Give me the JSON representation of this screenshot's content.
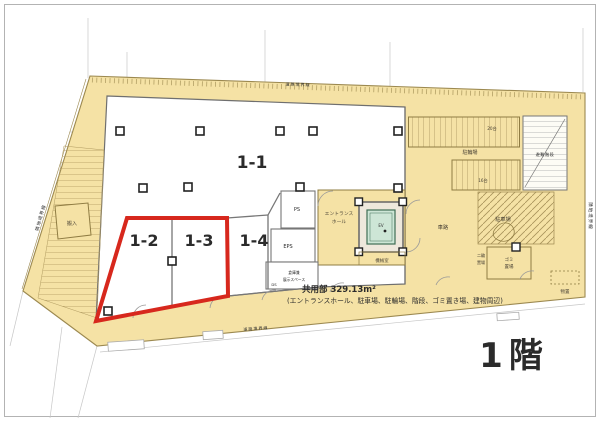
{
  "floor": {
    "label": "1階"
  },
  "common_area": {
    "line1": "共用部  329.13m²",
    "line2": "(エントランスホール、駐車場、駐輪場、階段、ゴミ置き場、建物周辺)"
  },
  "units": {
    "u11": "1-1",
    "u12": "1-2",
    "u13": "1-3",
    "u14": "1-4"
  },
  "labels": {
    "bike_parking": "駐輪場",
    "rack_20": "20台",
    "rack_16": "16台",
    "car_path": "車路",
    "parking": "駐車場",
    "garbage_1": "ゴミ",
    "garbage_2": "置場",
    "entrance_1": "エントランス",
    "entrance_2": "ホール",
    "ev": "EV",
    "machine_room": "機械室",
    "ps": "PS",
    "eps": "EPS",
    "ds": "DS",
    "storage_1": "倉庫兼",
    "storage_2": "展示スペース",
    "loading": "搬入",
    "two_wheel_1": "二輪",
    "two_wheel_2": "置場",
    "shed": "物置",
    "stairs": "避難階段"
  },
  "boundaries": {
    "left": "隣地境界線",
    "right": "隣地境界線",
    "top": "道路境界線",
    "bottom": "道路境界線"
  },
  "colors": {
    "tan": "#f5e2a5",
    "tan_dark": "#8f7c42",
    "red": "#d7281d",
    "ev_fill": "#cde6d6",
    "ev_stroke": "#3f6e55"
  }
}
